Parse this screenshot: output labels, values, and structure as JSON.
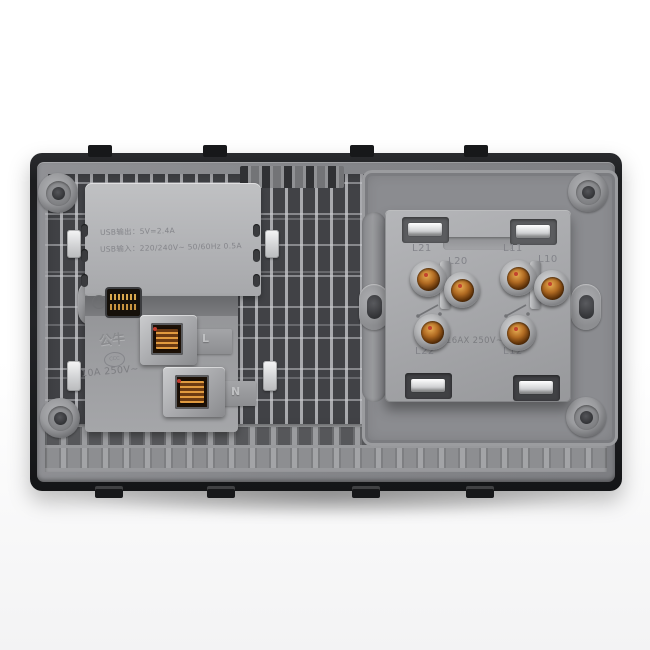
{
  "left_module": {
    "spec_line1": "USB输出：5V=2.4A",
    "spec_line2": "USB输入：220/240V~ 50/60Hz 0.5A",
    "brand": "公牛",
    "cert_mark": "CCC",
    "rating": "10A 250V~",
    "terminal_l_label": "L",
    "terminal_n_label": "N"
  },
  "right_module": {
    "rating": "16AX 250V~",
    "terminals": [
      {
        "label": "L21"
      },
      {
        "label": "L20"
      },
      {
        "label": "L11"
      },
      {
        "label": "L10"
      },
      {
        "label": "L22"
      },
      {
        "label": "L12"
      }
    ]
  },
  "colors": {
    "plate_edge": "#232427",
    "plate_face": "#85868a",
    "module_gray": "#b2b3b6",
    "copper_terminal": "#b06a22",
    "chrome_clip": "#e9eaec",
    "red_mark": "#c0392b",
    "background": "#ffffff"
  }
}
